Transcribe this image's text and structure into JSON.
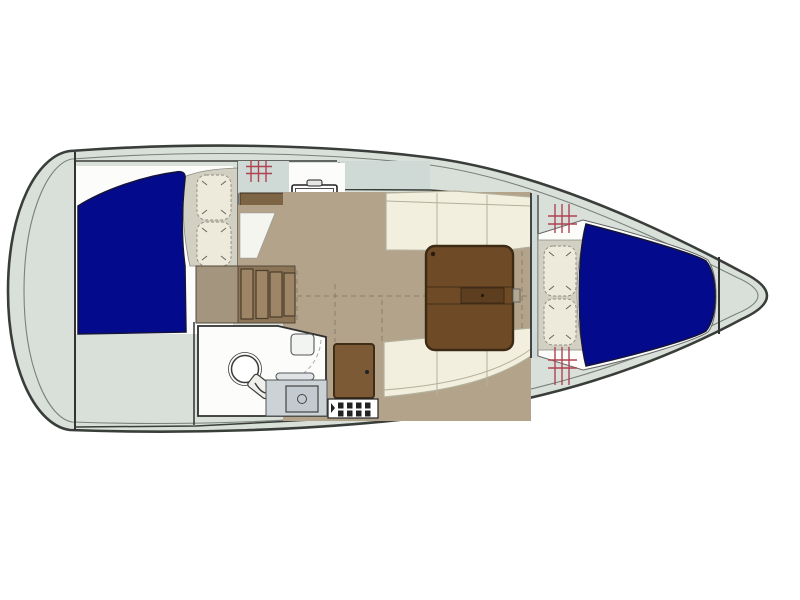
{
  "diagram": {
    "type": "yacht-floor-plan",
    "subject": "Sailboat interior layout, top-down view, bow facing right",
    "text_labels": []
  },
  "features": [
    "hull",
    "transom-platform",
    "aft-double-berth",
    "aft-berth-pillows",
    "companionway-steps",
    "galley-cabinet",
    "galley-stove",
    "galley-sink",
    "galley-fridge-grate",
    "galley-deck-hatch",
    "salon-sole",
    "port-settee",
    "starboard-settee",
    "salon-table",
    "head-compartment",
    "marine-toilet",
    "shower-mixer",
    "head-vanity-sink",
    "head-door",
    "entry-step-grate",
    "forward-bulkhead",
    "v-berth",
    "v-berth-pillows",
    "foredeck-hatches",
    "anchor-locker"
  ],
  "colors": {
    "page_bg": "#ffffff",
    "hull_line": "#3a3e3a",
    "inner_line": "#7a807a",
    "deck": "#d9e0da",
    "deck_band": "#cfdad6",
    "interior_white": "#fcfcfa",
    "berth_blue": "#040a8c",
    "berth_edge": "#14143c",
    "sole_tan": "#b2a38a",
    "sole_line": "#8a7d69",
    "cushion_cream": "#f2efdf",
    "cushion_line": "#b3b09c",
    "pillow_cream": "#edeadb",
    "pillow_base": "#d2d0c3",
    "table_brown": "#6e4a26",
    "table_line": "#3d2a15",
    "table_inset": "#5d3e1f",
    "steps_brown": "#8c7457",
    "steps_left": "#a3957e",
    "plank_brown": "#9d8566",
    "cabinet_brown": "#7d6445",
    "door_brown": "#7b5a35",
    "door_line": "#3f2d17",
    "hatch_red": "#b04352",
    "fixture_gray": "#ccd3d7",
    "fixture_mid": "#c2cacf",
    "wedge_white": "#f5f5ef",
    "line_dark": "#333333",
    "line_mid": "#666666"
  }
}
